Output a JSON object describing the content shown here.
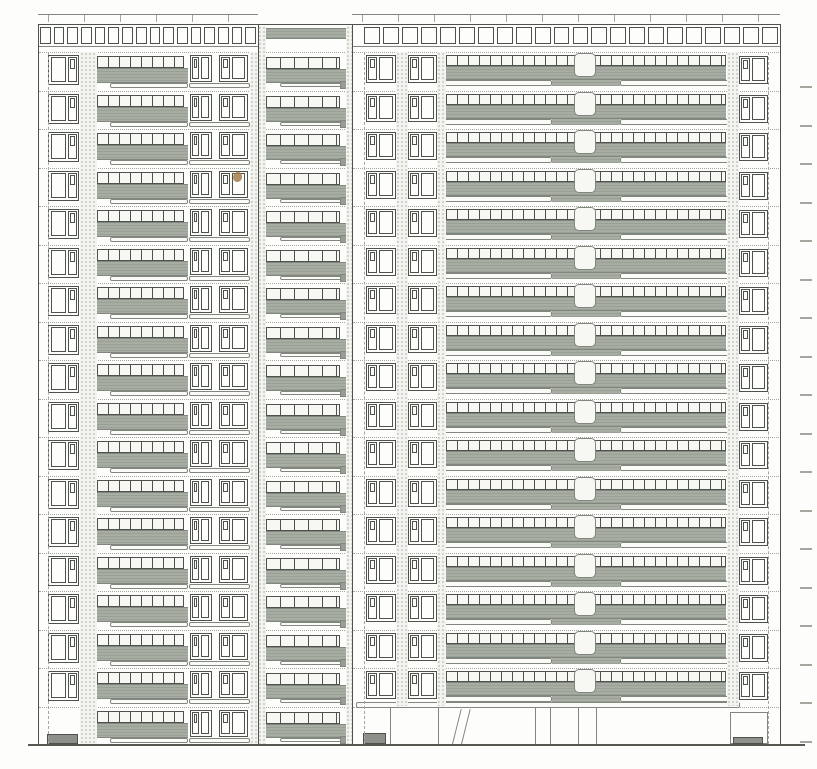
{
  "drawing": {
    "kind": "architectural-elevation",
    "subject": "multi-storey-apartment-building-facade",
    "colors": {
      "paper": "#fdfdfb",
      "line": "#4d524c",
      "line_soft": "#81877f",
      "line_faint": "#a2a89e",
      "balcony_fill": "#a8ada3",
      "balcony_hatch": "#99a095",
      "railing_fill": "#f7f7f3",
      "stipple_bg": "#f3f4ef",
      "stipple_dot": "#c5c9bf",
      "slab_fill": "#fbfbf8",
      "tab_fill": "#979d92",
      "dark_patch": "#8d9189",
      "speck": "#a57a48",
      "ground": "#55594f"
    },
    "geometry": {
      "canvas": {
        "w": 817,
        "h": 769
      },
      "ground_y": 744,
      "floors": {
        "count": 18,
        "top": 52,
        "pitch": 38.5
      },
      "roof": {
        "line1_y": 14,
        "line2_y": 24,
        "tick_h": 7,
        "tick_step": 36
      },
      "parapet": {
        "y": 27,
        "h": 17,
        "bottom_line_y": 46,
        "left": {
          "x": 40,
          "w": 216,
          "panels": 16
        },
        "right": {
          "x": 364,
          "w": 414,
          "panels": 22
        }
      },
      "left_block": {
        "x": 38,
        "w": 220,
        "x2": 258,
        "inner_dash_x": 48,
        "stipple_strips": [
          [
            80,
            17
          ],
          [
            250,
            8
          ]
        ],
        "window_a": {
          "x": 48,
          "w": 31,
          "dy": 3,
          "h": 30,
          "side": "right"
        },
        "railing": {
          "x": 97,
          "w": 87,
          "dy": 4,
          "h": 12,
          "mullion": 10
        },
        "band": {
          "x": 97,
          "w": 91,
          "dy": 16,
          "h": 15
        },
        "slab": {
          "x": 110,
          "w": 78,
          "dy": 31,
          "h": 5
        },
        "window_b": {
          "x": 190,
          "w": 22,
          "dy": 3,
          "h": 27,
          "side": "left"
        },
        "window_c": {
          "x": 219,
          "w": 29,
          "dy": 3,
          "h": 27,
          "side": "left"
        },
        "slab2": {
          "x": 189,
          "w": 61,
          "dy": 31,
          "h": 5
        },
        "entrance": {
          "x": 47,
          "y": 734,
          "w": 31,
          "h": 10
        }
      },
      "tower": {
        "x": 258,
        "w": 94,
        "x2": 352,
        "top_band": {
          "y": 28,
          "h": 11
        },
        "stipple_strips": [
          [
            258,
            8
          ],
          [
            346,
            6
          ]
        ],
        "railing": {
          "x": 266,
          "w": 74,
          "dy": 5,
          "h": 12,
          "mullion": 13
        },
        "band": {
          "x": 264,
          "w": 82,
          "dy": 17,
          "h": 14
        },
        "slab": {
          "x": 280,
          "w": 62,
          "dy": 31,
          "h": 4
        },
        "tab": {
          "x": 340,
          "w": 12,
          "dy": 29,
          "h": 8
        }
      },
      "right_block": {
        "x": 352,
        "w": 428,
        "x2": 780,
        "inner_dash_x": 364,
        "edge_dash_x": 768,
        "balcony_floors": 17,
        "stipple_strips": [
          [
            396,
            12
          ],
          [
            437,
            9
          ],
          [
            727,
            12
          ]
        ],
        "window_d": {
          "x": 366,
          "w": 30,
          "dy": 3,
          "h": 28,
          "side": "left"
        },
        "window_e": {
          "x": 408,
          "w": 29,
          "dy": 3,
          "h": 28,
          "side": "left"
        },
        "railing": {
          "x": 446,
          "w": 280,
          "dy": 3,
          "h": 11,
          "mullion": 10
        },
        "band": {
          "x": 446,
          "w": 280,
          "dy": 14,
          "h": 14
        },
        "center_ext": {
          "x": 552,
          "w": 68,
          "dy": 28,
          "h": 6
        },
        "slab_left": {
          "x": 443,
          "w": 109,
          "dy": 28,
          "h": 6
        },
        "slab_right": {
          "x": 620,
          "w": 117,
          "dy": 28,
          "h": 6
        },
        "core_pier": {
          "x": 574,
          "w": 22,
          "dy": 1,
          "h": 24
        },
        "window_f": {
          "x": 739,
          "w": 29,
          "dy": 4,
          "h": 28,
          "side": "left"
        },
        "ground": {
          "slab_bar": {
            "x": 356,
            "w": 384,
            "y": 702,
            "h": 6
          },
          "vlines": [
            390,
            438,
            535,
            550,
            578,
            596
          ],
          "canopy_x": [
            452,
            461
          ],
          "door_frame": {
            "x": 730,
            "w": 38,
            "y": 712,
            "h": 32
          },
          "patch1": {
            "x": 363,
            "w": 23,
            "y": 733,
            "h": 11
          },
          "patch2": {
            "x": 733,
            "w": 30,
            "y": 737,
            "h": 7
          }
        }
      },
      "level_ticks": {
        "x": 800,
        "w": 12,
        "dy": 34
      },
      "speck": {
        "x": 233,
        "y": 172,
        "w": 9,
        "h": 10
      }
    }
  }
}
